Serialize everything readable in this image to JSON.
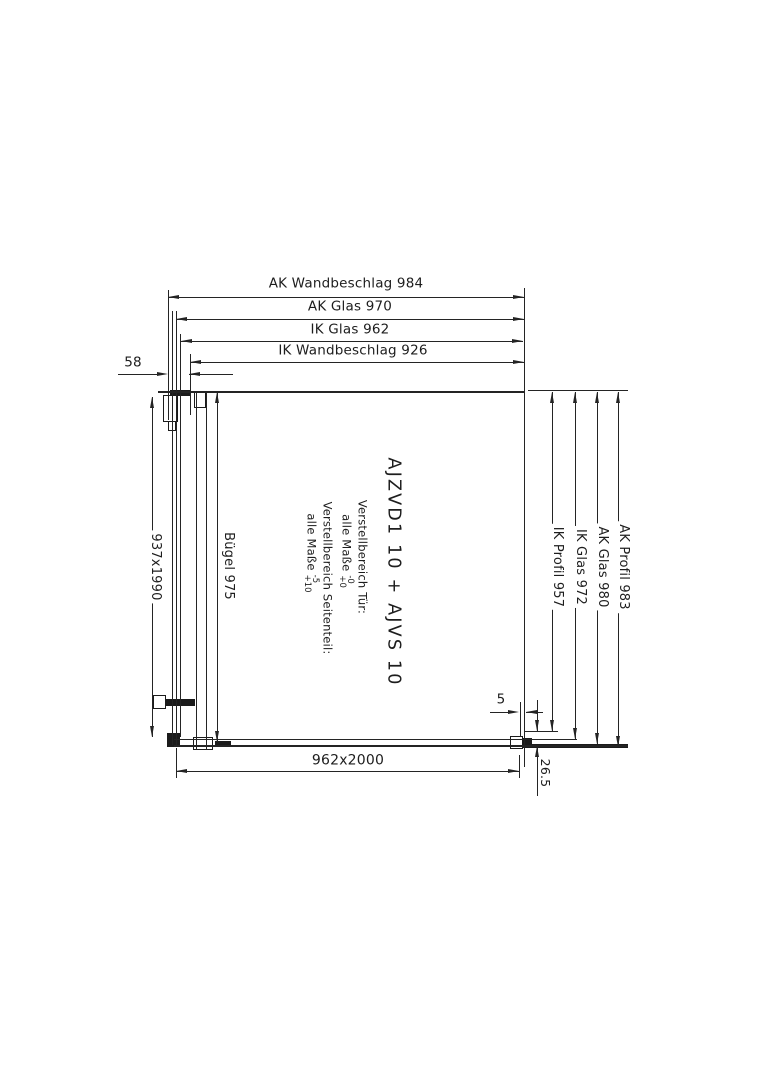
{
  "drawing": {
    "product_title": "AJZVD1 10 + AJVS 10",
    "top_dimensions": [
      {
        "label": "AK Wandbeschlag 984"
      },
      {
        "label": "AK Glas 970"
      },
      {
        "label": "IK Glas 962"
      },
      {
        "label": "IK Wandbeschlag 926"
      }
    ],
    "left_dimensions": {
      "wall_offset": "58",
      "door_glass": "937x1990",
      "bracket": "Bügel 975"
    },
    "right_dimensions": [
      {
        "label": "IK Profil 957"
      },
      {
        "label": "IK Glas 972"
      },
      {
        "label": "AK Glas 980"
      },
      {
        "label": "AK Profil 983"
      }
    ],
    "bottom_dimensions": {
      "overall": "962x2000",
      "gap": "5",
      "profile_height": "26.5"
    },
    "adjustment_notes": {
      "door_title": "Verstellbereich Tür:",
      "door_text": "alle Maße",
      "door_tol_upper": "-0",
      "door_tol_lower": "+0",
      "side_title": "Verstellbereich Seitenteil:",
      "side_text": "alle Maße",
      "side_tol_upper": "-5",
      "side_tol_lower": "+10"
    },
    "colors": {
      "line": "#242424",
      "background": "#ffffff"
    }
  }
}
